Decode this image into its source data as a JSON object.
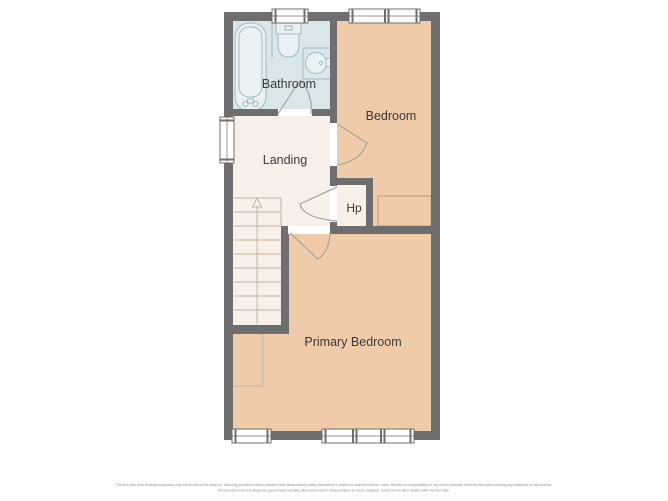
{
  "rooms": {
    "bathroom": {
      "label": "Bathroom"
    },
    "bedroom": {
      "label": "Bedroom"
    },
    "landing": {
      "label": "Landing"
    },
    "hp": {
      "label": "Hp"
    },
    "primary_bedroom": {
      "label": "Primary Bedroom"
    }
  },
  "disclaimer": {
    "line1": "The floor plan is for illustration purposes only and should not be relied on. Intending purchasers and/or lessees must independently satisfy themselves in relation to exact floor areas / sizes. We take no responsibility for any errors contained within the floor plan including any omissions or inaccuracies.",
    "line2": "All measurements and details are approximate including dimensions and/or measurements for doors, windows, rooms and all other details within the floor plan."
  },
  "colors": {
    "wall": "#6e6e6e",
    "bathroom_floor": "#d9e6ea",
    "bedroom_floor": "#f0cbaa",
    "landing_floor": "#f7f0e8",
    "opening": "#ffffff",
    "fixture_line": "#9fb9c2",
    "fixture_fill": "#e9f1f3",
    "window_fill": "#ffffff",
    "window_line": "#6f6f6f",
    "stair_line": "#c4b5a3",
    "furniture_line": "#c09a78",
    "door_line": "#9a9a9a",
    "label_text": "#3a3a3a",
    "disclaimer_text": "#8d8d8d"
  }
}
